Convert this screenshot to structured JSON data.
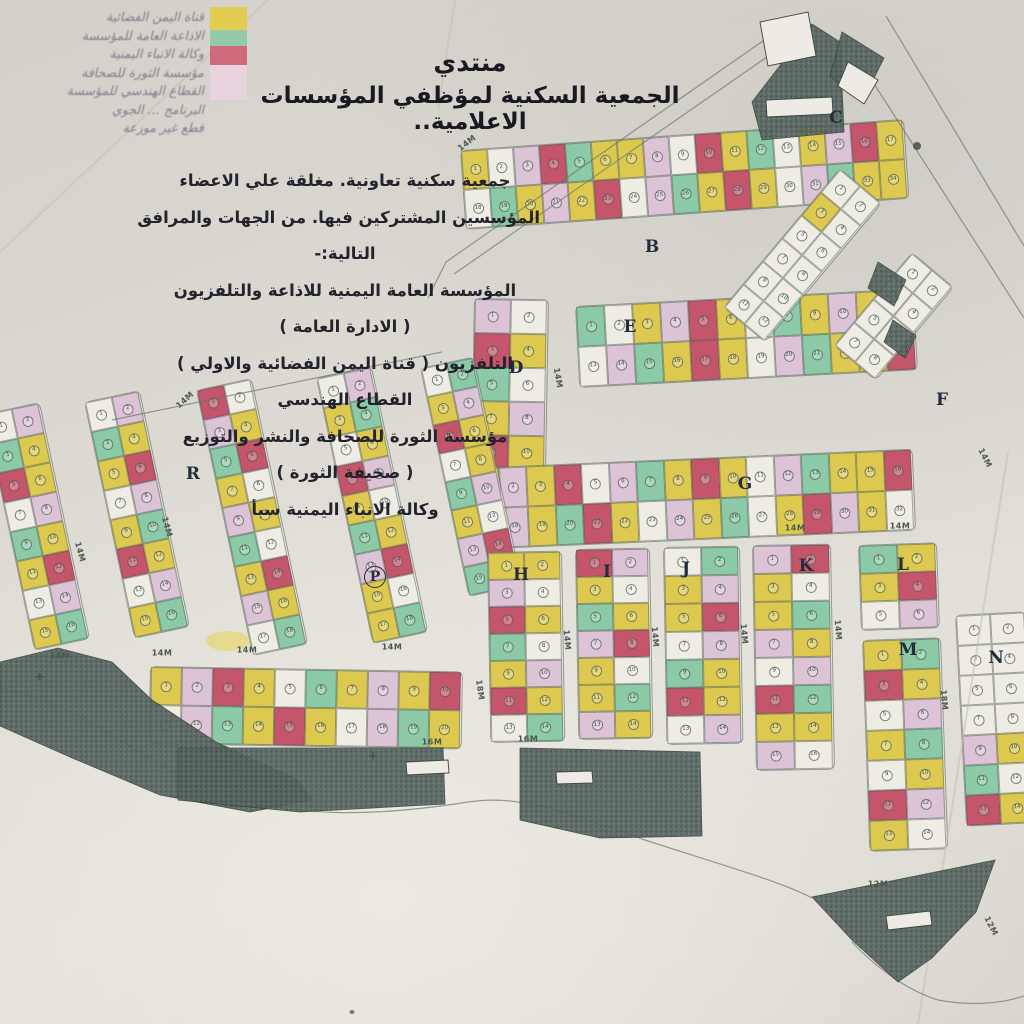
{
  "title": {
    "line1": "منتدي",
    "line2": "الجمعية السكنية لمؤظفي المؤسسات الاعلامية.."
  },
  "intro": {
    "lines": [
      "جمعية سكنية تعاونية. مغلقة علي الاعضاء",
      "المؤسسين المشتركين فيها. من الجهات والمرافق",
      "التالية:-",
      "المؤسسة العامة اليمنية للاذاعة والتلفزيون",
      "( الادارة العامة )",
      "التلفزيون ( قناة اليمن الفضائية والاولي )",
      "القطاع الهندسي",
      "مؤسسة الثورة للصحافة والنشر والتوزيع",
      "( صحيفة الثورة )",
      "وكالة الانباء اليمنية سبأ"
    ]
  },
  "legend": {
    "lines": [
      "قناة اليمن الفضائية",
      "الاذاعة العامة للمؤسسة",
      "وكالة الانباء اليمنية",
      "مؤسسة الثورة للصحافة",
      "القطاع الهندسي للمؤسسة",
      "البرنامج … الجوي",
      "قطع غير موزعة"
    ],
    "swatches": [
      {
        "name": "yellow-plots",
        "color": "#e2cc52",
        "h": 23
      },
      {
        "name": "teal-plots",
        "color": "#93cbaa",
        "h": 16
      },
      {
        "name": "rose-plots",
        "color": "#cf6a7c",
        "h": 19
      },
      {
        "name": "pink-plots",
        "color": "#e8d3de",
        "h": 35
      }
    ]
  },
  "palette": {
    "Y": "#ddc94f",
    "T": "#8cc9a6",
    "R": "#c4556a",
    "P": "#ddc3d6",
    "W": "#efece3"
  },
  "map": {
    "color_cycle": "YWPRTYYPWRYTWYPRYWTYPYRWPTYRYWPTYYRWPYTRYWPYTWYRPYWTYPRYWYTP",
    "blocks": [
      {
        "id": "B-top",
        "x": 460,
        "y": 150,
        "rot": -4,
        "cols": 17,
        "rows": 2,
        "cw": 26,
        "ch": 39,
        "offset": 0
      },
      {
        "id": "D",
        "x": 474,
        "y": 298,
        "rot": 1,
        "cols": 2,
        "rows": 7,
        "cw": 36,
        "ch": 34,
        "offset": 7
      },
      {
        "id": "E",
        "x": 575,
        "y": 306,
        "rot": -3,
        "cols": 12,
        "rows": 2,
        "cw": 28,
        "ch": 40,
        "offset": 11
      },
      {
        "id": "G",
        "x": 470,
        "y": 468,
        "rot": -2.5,
        "cols": 16,
        "rows": 2,
        "cw": 27.5,
        "ch": 40,
        "offset": 19
      },
      {
        "id": "C-road",
        "x": 840,
        "y": 168,
        "rot": 40,
        "cols": 2,
        "rows": 6,
        "cw": 26,
        "ch": 30,
        "colors": "WWYWWWWWWWWW"
      },
      {
        "id": "F-area",
        "x": 912,
        "y": 252,
        "rot": 40,
        "cols": 2,
        "rows": 4,
        "cw": 26,
        "ch": 30,
        "colors": "WWWWWWWW"
      },
      {
        "id": "left-1",
        "x": -16,
        "y": 414,
        "rot": -12,
        "cols": 2,
        "rows": 8,
        "cw": 27,
        "ch": 30,
        "offset": 23
      },
      {
        "id": "left-2",
        "x": 84,
        "y": 402,
        "rot": -12,
        "cols": 2,
        "rows": 8,
        "cw": 27,
        "ch": 30,
        "offset": 29
      },
      {
        "id": "left-3",
        "x": 196,
        "y": 390,
        "rot": -12,
        "cols": 2,
        "rows": 9,
        "cw": 27,
        "ch": 30,
        "offset": 34
      },
      {
        "id": "left-4",
        "x": 316,
        "y": 378,
        "rot": -12,
        "cols": 2,
        "rows": 9,
        "cw": 27,
        "ch": 30,
        "offset": 41
      },
      {
        "id": "left-5",
        "x": 420,
        "y": 368,
        "rot": -12,
        "cols": 2,
        "rows": 8,
        "cw": 26,
        "ch": 29,
        "offset": 50
      },
      {
        "id": "row-14M-16M",
        "x": 150,
        "y": 666,
        "rot": 1,
        "cols": 10,
        "rows": 2,
        "cw": 31,
        "ch": 38,
        "offset": 13
      },
      {
        "id": "H",
        "x": 487,
        "y": 552,
        "rot": -1,
        "cols": 2,
        "rows": 7,
        "cw": 36,
        "ch": 27,
        "offset": 5
      },
      {
        "id": "I",
        "x": 575,
        "y": 549,
        "rot": -1,
        "cols": 2,
        "rows": 7,
        "cw": 36,
        "ch": 27,
        "offset": 47
      },
      {
        "id": "J",
        "x": 663,
        "y": 547,
        "rot": -1,
        "cols": 2,
        "rows": 7,
        "cw": 37,
        "ch": 28,
        "offset": 17
      },
      {
        "id": "K",
        "x": 752,
        "y": 545,
        "rot": -1,
        "cols": 2,
        "rows": 8,
        "cw": 38,
        "ch": 28,
        "offset": 53
      },
      {
        "id": "L",
        "x": 858,
        "y": 545,
        "rot": -2,
        "cols": 2,
        "rows": 3,
        "cw": 38,
        "ch": 28,
        "offset": 31
      },
      {
        "id": "M",
        "x": 862,
        "y": 640,
        "rot": -2,
        "cols": 2,
        "rows": 7,
        "cw": 38,
        "ch": 30,
        "offset": 37
      },
      {
        "id": "N",
        "x": 955,
        "y": 615,
        "rot": -3,
        "cols": 2,
        "rows": 7,
        "cw": 34,
        "ch": 30,
        "colors": "WWWWWWWWPYTWRY"
      }
    ],
    "letters": [
      {
        "ch": "B",
        "x": 652,
        "y": 247
      },
      {
        "ch": "C",
        "x": 836,
        "y": 118
      },
      {
        "ch": "D",
        "x": 516,
        "y": 368
      },
      {
        "ch": "E",
        "x": 630,
        "y": 327
      },
      {
        "ch": "F",
        "x": 942,
        "y": 400
      },
      {
        "ch": "G",
        "x": 745,
        "y": 484
      },
      {
        "ch": "H",
        "x": 521,
        "y": 575
      },
      {
        "ch": "I",
        "x": 607,
        "y": 572
      },
      {
        "ch": "J",
        "x": 686,
        "y": 569
      },
      {
        "ch": "K",
        "x": 806,
        "y": 566
      },
      {
        "ch": "L",
        "x": 903,
        "y": 565
      },
      {
        "ch": "M",
        "x": 908,
        "y": 650
      },
      {
        "ch": "N",
        "x": 996,
        "y": 658
      },
      {
        "ch": "P",
        "x": 375,
        "y": 577,
        "circled": true
      },
      {
        "ch": "R",
        "x": 193,
        "y": 474
      }
    ],
    "street_labels": [
      {
        "t": "14M",
        "x": 467,
        "y": 143,
        "r": -38
      },
      {
        "t": "14M",
        "x": 185,
        "y": 400,
        "r": -42
      },
      {
        "t": "14M",
        "x": 80,
        "y": 552,
        "r": 75
      },
      {
        "t": "14M",
        "x": 167,
        "y": 527,
        "r": 75
      },
      {
        "t": "14M",
        "x": 558,
        "y": 378,
        "r": 80
      },
      {
        "t": "14M",
        "x": 795,
        "y": 528,
        "r": 0
      },
      {
        "t": "14M",
        "x": 900,
        "y": 526,
        "r": 0
      },
      {
        "t": "14M",
        "x": 60,
        "y": 656,
        "r": 0
      },
      {
        "t": "14M",
        "x": 162,
        "y": 653,
        "r": 0
      },
      {
        "t": "14M",
        "x": 247,
        "y": 650,
        "r": 0
      },
      {
        "t": "14M",
        "x": 392,
        "y": 647,
        "r": 0
      },
      {
        "t": "16M",
        "x": 432,
        "y": 742,
        "r": 0
      },
      {
        "t": "16M",
        "x": 528,
        "y": 739,
        "r": 0
      },
      {
        "t": "12M",
        "x": 878,
        "y": 884,
        "r": 0
      },
      {
        "t": "12M",
        "x": 991,
        "y": 926,
        "r": 63
      },
      {
        "t": "18M",
        "x": 480,
        "y": 690,
        "r": 82
      },
      {
        "t": "14M",
        "x": 567,
        "y": 640,
        "r": 85
      },
      {
        "t": "14M",
        "x": 655,
        "y": 637,
        "r": 85
      },
      {
        "t": "14M",
        "x": 744,
        "y": 634,
        "r": 85
      },
      {
        "t": "14M",
        "x": 838,
        "y": 630,
        "r": 85
      },
      {
        "t": "18M",
        "x": 944,
        "y": 700,
        "r": 85
      },
      {
        "t": "14M",
        "x": 985,
        "y": 458,
        "r": 63
      }
    ],
    "roads": [
      {
        "d": "M770,36 L446,262 L428,298"
      },
      {
        "d": "M780,48 L454,274"
      },
      {
        "d": "M846,40 L1024,318"
      },
      {
        "d": "M886,16 L1024,246"
      },
      {
        "d": "M112,420 L442,352"
      },
      {
        "d": "M0,688 C80,702 140,762 212,790 C292,820 380,816 468,802"
      },
      {
        "d": "M468,802 C520,794 565,812 645,840 C725,866 782,882 812,898"
      },
      {
        "d": "M852,942 C880,972 912,992 938,1000"
      },
      {
        "d": "M938,1000 C970,1006 1000,1004 1024,996"
      }
    ],
    "creases": [
      {
        "d": "M268,0 L0,252"
      },
      {
        "d": "M1008,452 L918,1024"
      },
      {
        "d": "M455,0 L438,110"
      }
    ],
    "hatches": [
      {
        "name": "dark-triangle-top-right",
        "d": "M752,102 L812,24 L840,42 L844,132 L762,140 Z"
      },
      {
        "name": "dark-wedge-top-right",
        "d": "M842,32 L884,58 L862,102 L830,76 Z"
      },
      {
        "name": "dark-wadi-band-left",
        "d": "M0,662 L58,648 L112,662 L152,700 L216,742 L298,780 L312,800 L250,812 L160,795 L70,757 L0,726 Z"
      },
      {
        "name": "dark-strip-center-a",
        "d": "M178,748 L443,748 L445,804 L300,812 L178,800 Z"
      },
      {
        "name": "dark-strip-center-b",
        "d": "M520,748 L700,752 L702,836 L600,838 L520,820 Z"
      },
      {
        "name": "dark-triangle-bottom-right",
        "d": "M812,897 L995,860 L976,912 L932,958 L898,982 L852,940 Z"
      },
      {
        "name": "dark-spot-road-1",
        "d": "M878,262 L906,280 L894,306 L868,288 Z"
      },
      {
        "name": "dark-spot-road-2",
        "d": "M893,320 L916,336 L905,358 L884,342 Z"
      }
    ],
    "white_shapes": [
      {
        "name": "diamond-plot-top-right",
        "d": "M760,22 L808,12 L816,56 L768,66 Z"
      },
      {
        "name": "label-box-top-right",
        "d": "M766,100 L832,97 L833,114 L767,117 Z"
      },
      {
        "name": "label-box-top-right-2",
        "d": "M848,62 L878,80 L864,104 L838,86 Z"
      },
      {
        "name": "label-box-center-a",
        "d": "M406,762 L448,760 L449,773 L407,775 Z"
      },
      {
        "name": "label-box-center-b",
        "d": "M556,772 L592,771 L593,783 L557,784 Z"
      },
      {
        "name": "label-box-bottom-right",
        "d": "M886,916 L930,911 L932,925 L888,930 Z"
      }
    ],
    "spots": [
      {
        "cx": 228,
        "cy": 641,
        "rx": 22,
        "ry": 10,
        "fill": "#e7d34e",
        "op": 0.55
      },
      {
        "cx": 917,
        "cy": 146,
        "rx": 4,
        "ry": 4,
        "fill": "#3c4540",
        "op": 0.8
      },
      {
        "cx": 352,
        "cy": 1012,
        "rx": 2.5,
        "ry": 2,
        "fill": "#555f59",
        "op": 0.8
      }
    ],
    "symbols": [
      {
        "name": "mosque-cross-symbol",
        "ch": "✚",
        "x": 373,
        "y": 757
      },
      {
        "name": "mosque-cross-symbol",
        "ch": "✚",
        "x": 40,
        "y": 678
      }
    ]
  }
}
